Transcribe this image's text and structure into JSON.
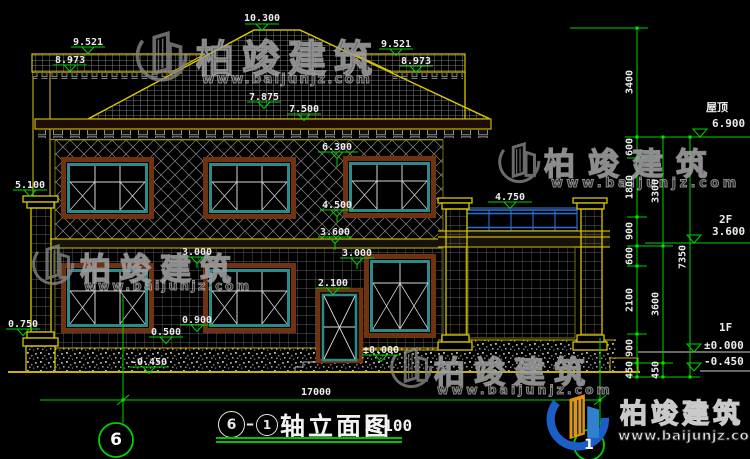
{
  "colors": {
    "background": "#000000",
    "dimension_green": "#00d400",
    "outline_yellow": "#c8b400",
    "window_teal": "#2d8a8a",
    "trim_brown": "#6f3312",
    "railing_blue": "#2f6fd8",
    "logo_blue": "#1d5ec6",
    "logo_orange": "#e8920c"
  },
  "levels": {
    "ridge": "10.300",
    "band_l_top": "9.521",
    "band_l_bot": "8.973",
    "band_r_top": "9.521",
    "band_r_bot": "8.973",
    "slope_upper": "7.875",
    "eave_top": "7.500",
    "win2_top": "6.300",
    "porch_cap": "5.100",
    "railing_top": "4.750",
    "win2_sill": "4.500",
    "floor2": "3.600",
    "lintel_left": "3.000",
    "lintel_right": "3.000",
    "door_top": "2.100",
    "win1_sill": "0.900",
    "porch_base": "0.750",
    "plinth_top": "0.500",
    "ground": "-0.450",
    "door_zero": "±0.000"
  },
  "right_levels": {
    "roof_label": "屋顶",
    "roof_value": "6.900",
    "f2_label": "2F",
    "f2_value": "3.600",
    "f1_label": "1F",
    "f1_value": "±0.000",
    "ground_value": "-0.450"
  },
  "chain_a": [
    "3400",
    "600",
    "1800",
    "900",
    "600",
    "2100",
    "900",
    "450"
  ],
  "chain_b": [
    "3300",
    "3600",
    "450"
  ],
  "chain_c": [
    "7350"
  ],
  "bottom": {
    "total_width": "17000",
    "axis_left": "6",
    "axis_right": "1"
  },
  "title": {
    "bubble_left": "6",
    "separator": "–",
    "bubble_right": "1",
    "text": "轴立面图",
    "scale": "1:100"
  },
  "watermark": {
    "name": "柏竣建筑",
    "url": "www.baijunjz.com"
  },
  "brand": {
    "name": "柏竣建筑",
    "url": "www.baijunjz.com"
  }
}
